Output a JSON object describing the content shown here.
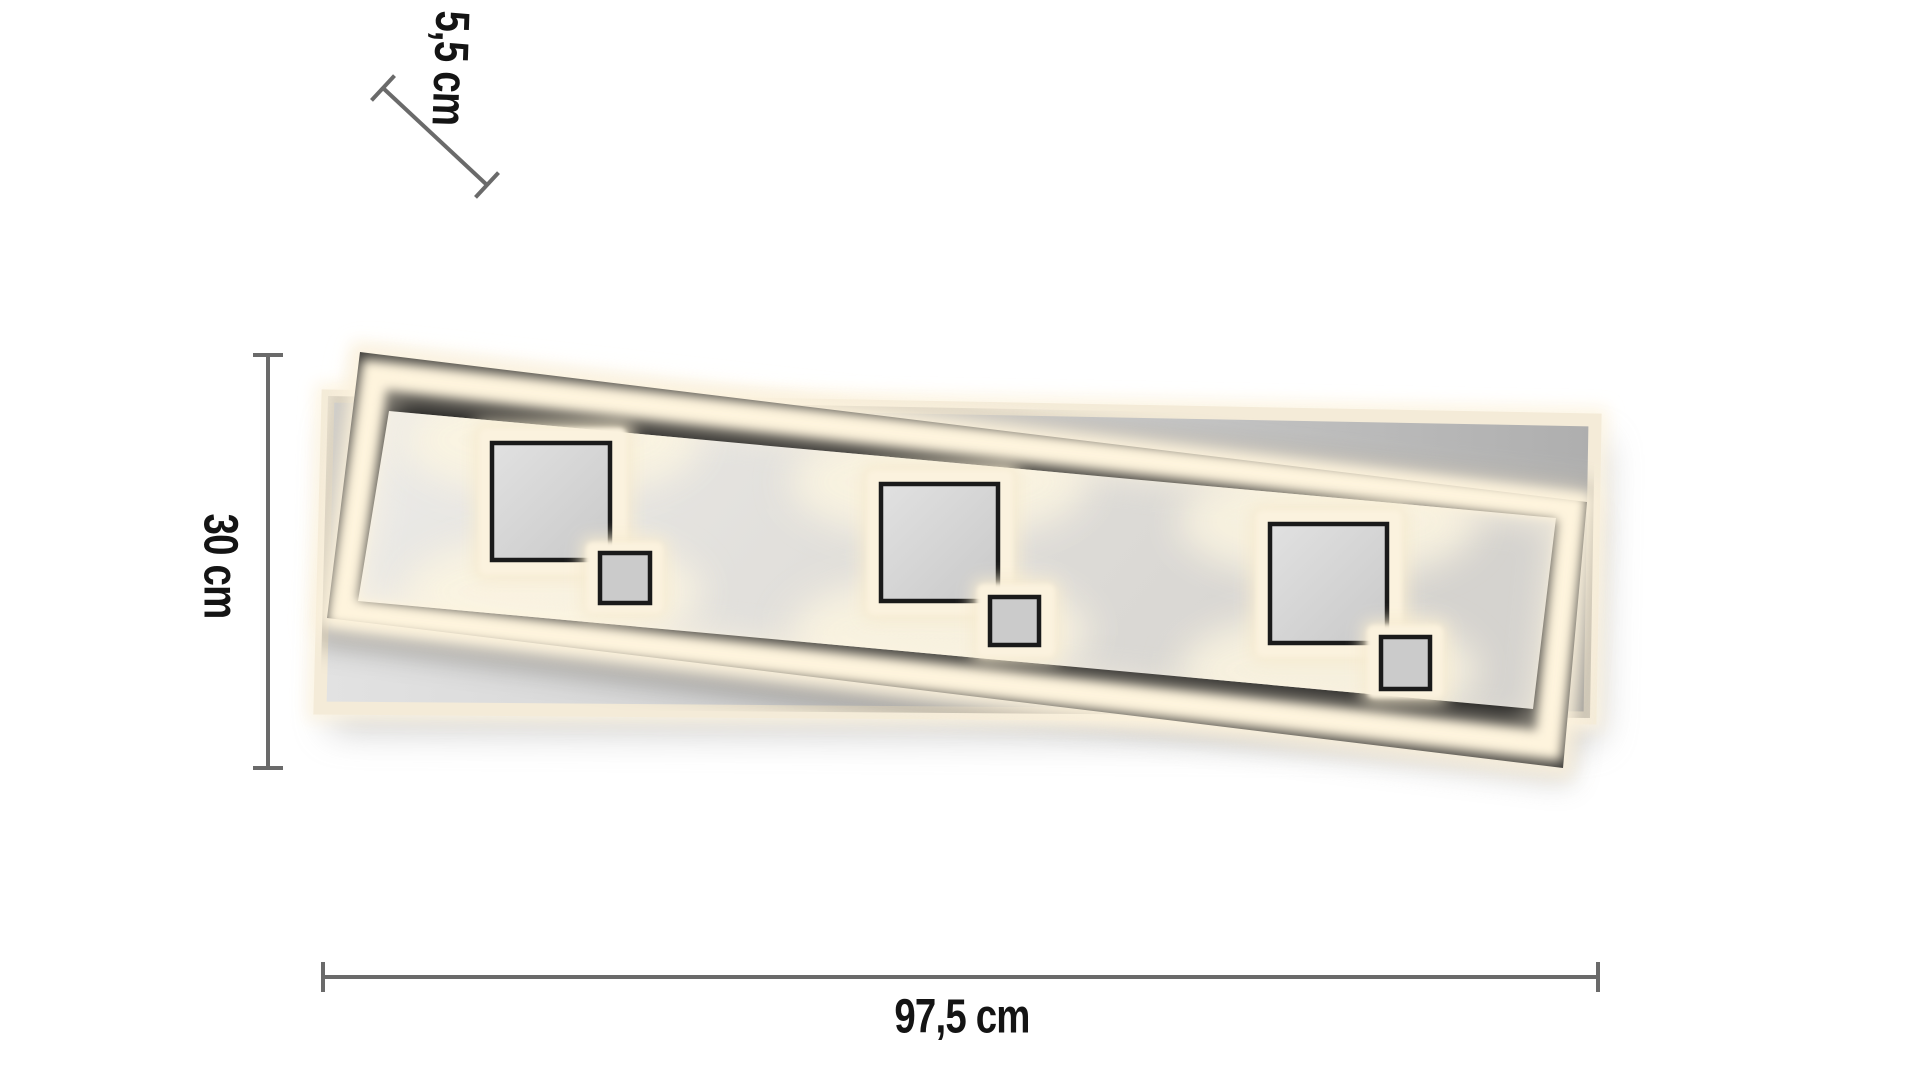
{
  "diagram": {
    "type": "product-dimension-diagram",
    "product_name": "rectangular-led-ceiling-light-3-square-modules",
    "module_count": 3,
    "dimensions": {
      "depth": {
        "label": "5,5 cm",
        "value_cm": 5.5
      },
      "height": {
        "label": "30 cm",
        "value_cm": 30
      },
      "width": {
        "label": "97,5 cm",
        "value_cm": 97.5
      }
    },
    "colors": {
      "background": "#ffffff",
      "dimension_line": "#6a6a6a",
      "label_text": "#141414",
      "frame_black": "#161616",
      "glow_warm_white": "#f8eed6",
      "panel_gray": "#d4d2ce",
      "back_panel_gray": "#c9c9c9"
    }
  }
}
